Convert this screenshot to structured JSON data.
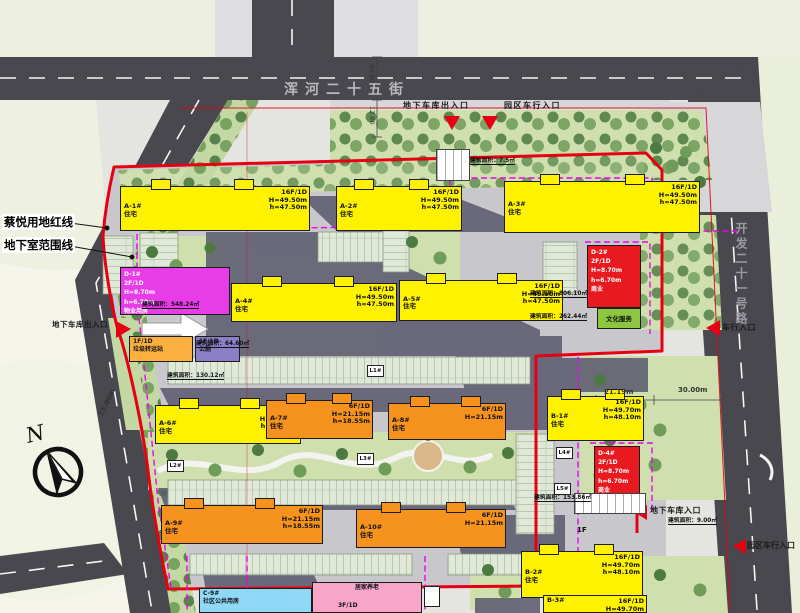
{
  "plan": {
    "streets": {
      "top": "浑河二十五街",
      "right": "开发二十一号路"
    },
    "legend": {
      "red_line": "蔡悦用地红线",
      "basement_line": "地下室范围线"
    },
    "compass_n": "N",
    "entrances": {
      "top_garage": "地下车库出入口",
      "top_vehicle": "园区车行入口",
      "left_garage": "地下车库出入口",
      "right_vehicle": "车行入口",
      "br_garage": "地下车库入口",
      "br_vehicle": "园区车行入口"
    },
    "dimensions": {
      "road_top_width": "30.00",
      "road_top_offset": "12.00",
      "right_gap": "21.19m",
      "right_road_width": "30.00m",
      "left_road_width": "15.00m"
    },
    "areas": {
      "d1": "建筑面积：548.24㎡",
      "toilet": "建筑面积：64.60㎡",
      "station": "建筑面积：130.12㎡",
      "d2": "建筑面积：806.10㎡",
      "culture": "建筑面积：262.44㎡",
      "d4": "建筑面积：153.86㎡",
      "gate2": "建筑面积：9.00㎡",
      "gate1": "建筑面积：7.5㎡"
    },
    "markers": {
      "l1": "L1#",
      "l2": "L2#",
      "l3": "L3#",
      "l4": "L4#",
      "l5": "L5#",
      "gate_floor": "1F"
    },
    "buildings": [
      {
        "id": "A-1#",
        "use": "住宅",
        "f": "16F/1D",
        "H": "H=49.50m",
        "h": "h=47.50m"
      },
      {
        "id": "A-2#",
        "use": "住宅",
        "f": "16F/1D",
        "H": "H=49.50m",
        "h": "h=47.50m"
      },
      {
        "id": "A-3#",
        "use": "住宅",
        "f": "16F/1D",
        "H": "H=49.50m",
        "h": "h=47.50m"
      },
      {
        "id": "A-4#",
        "use": "住宅",
        "f": "16F/1D",
        "H": "H=49.50m",
        "h": "h=47.50m"
      },
      {
        "id": "A-5#",
        "use": "住宅",
        "f": "16F/1D",
        "H": "H=49.50m",
        "h": "h=47.50m"
      },
      {
        "id": "A-6#",
        "use": "住宅",
        "f": "14F",
        "H": "H=43.70m",
        "h": "h=41.70m"
      },
      {
        "id": "A-7#",
        "use": "住宅",
        "f": "6F/1D",
        "H": "H=21.15m",
        "h": "h=18.55m"
      },
      {
        "id": "A-8#",
        "use": "住宅",
        "f": "6F/1D",
        "H": "H=21.15m",
        "h": ""
      },
      {
        "id": "A-9#",
        "use": "住宅",
        "f": "6F/1D",
        "H": "H=21.15m",
        "h": "h=18.55m"
      },
      {
        "id": "A-10#",
        "use": "住宅",
        "f": "6F/1D",
        "H": "H=21.15m",
        "h": ""
      },
      {
        "id": "B-1#",
        "use": "住宅",
        "f": "16F/1D",
        "H": "H=49.70m",
        "h": "h=48.10m"
      },
      {
        "id": "B-2#",
        "use": "住宅",
        "f": "16F/1D",
        "H": "H=49.70m",
        "h": "h=48.10m"
      },
      {
        "id": "B-3#",
        "use": "住宅",
        "f": "16F/1D",
        "H": "H=49.70m",
        "h": ""
      }
    ],
    "special": {
      "d1": {
        "id": "D-1#",
        "f": "2F/1D",
        "H": "H=8.70m",
        "h": "h=6.70m",
        "use": "物业用房"
      },
      "d2": {
        "id": "D-2#",
        "f": "2F/1D",
        "H": "H=8.70m",
        "h": "h=6.70m",
        "use": "商业",
        "sub": "文化服务"
      },
      "d4": {
        "id": "D-4#",
        "f": "2F/1D",
        "H": "H=8.70m",
        "h": "h=6.70m",
        "use": "商业"
      },
      "station": {
        "f": "1F/1D",
        "use": "垃圾转运站"
      },
      "toilet": {
        "f": "1F/1D",
        "use": "公厕"
      },
      "c9": {
        "id": "C-9#",
        "use": "社区公共用房",
        "use2": "居家养老",
        "f": "3F/1D"
      }
    }
  }
}
